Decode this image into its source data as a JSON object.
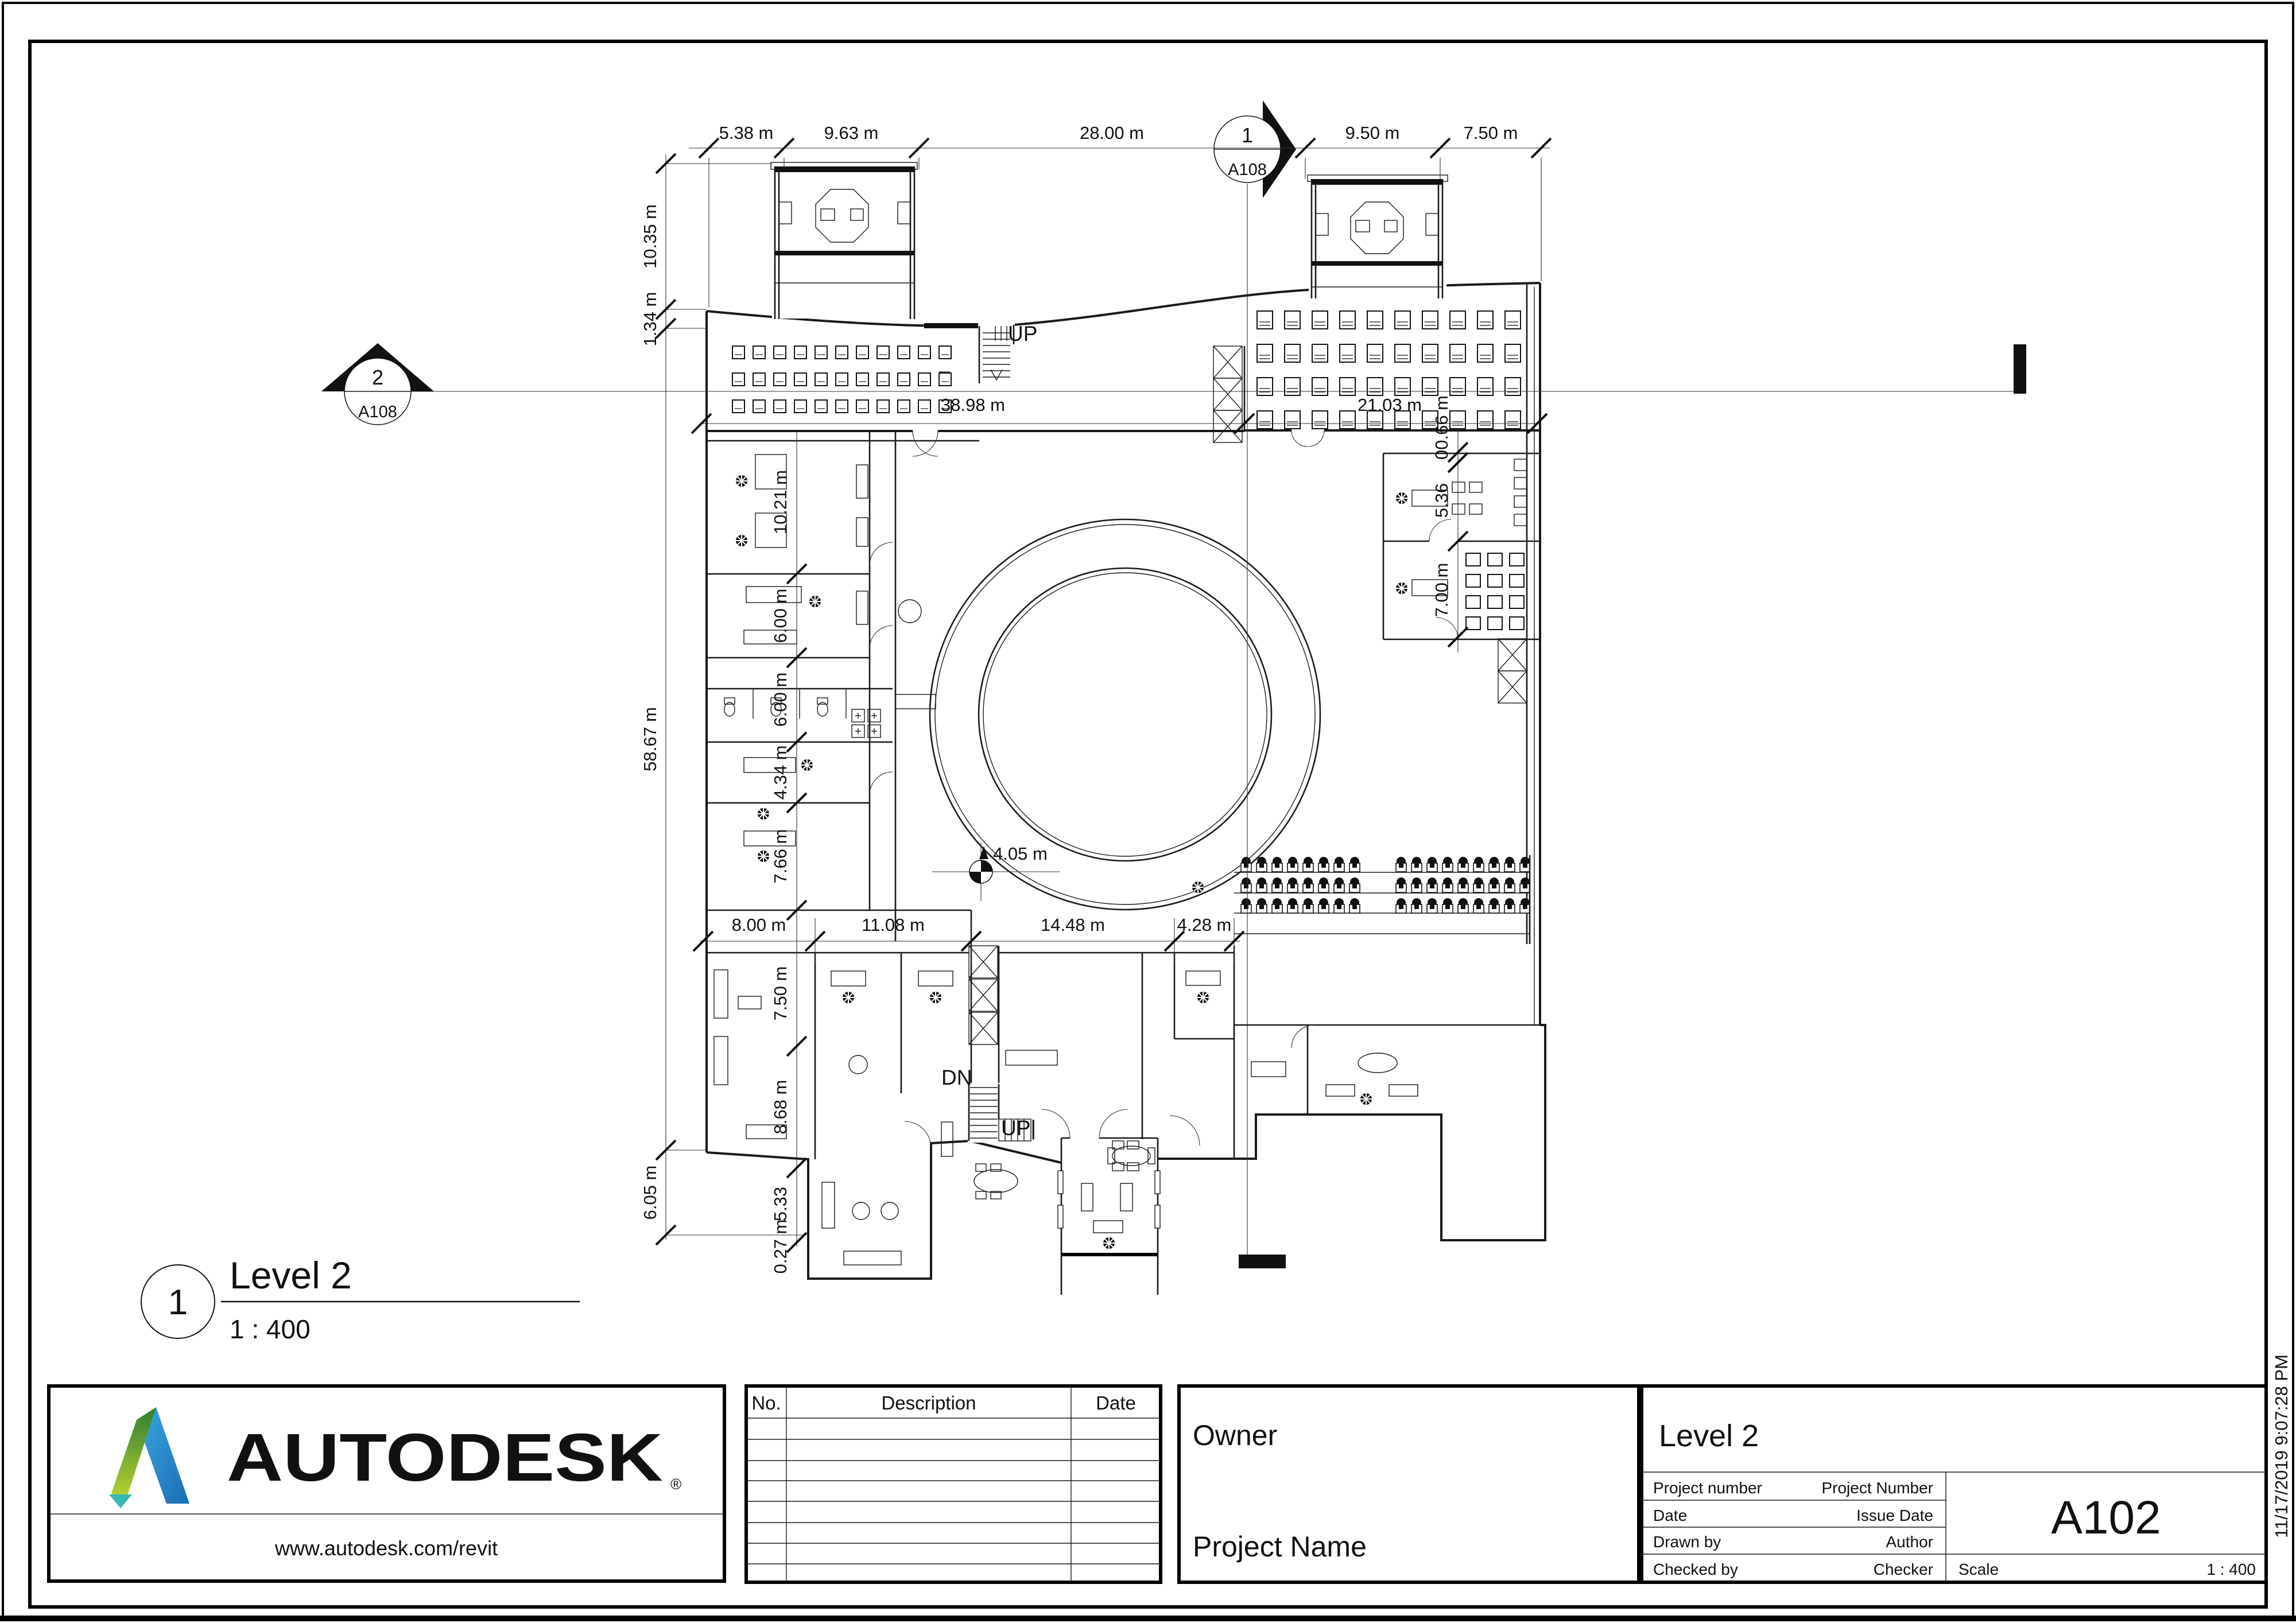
{
  "drawing": {
    "view": {
      "number": "1",
      "name": "Level 2",
      "scale": "1 : 400"
    },
    "stair_labels": {
      "upper": "UP",
      "down": "DN",
      "lower": "UP|"
    },
    "spot_dim": "4.05 m",
    "section_markers": {
      "one": {
        "number": "1",
        "sheet": "A108"
      },
      "two": {
        "number": "2",
        "sheet": "A108"
      }
    },
    "dims": {
      "top": [
        "5.38 m",
        "9.63 m",
        "28.00 m",
        "9.50 m",
        "7.50 m"
      ],
      "left_outer": [
        "10.35 m",
        "1.34 m",
        "58.67 m",
        "6.05 m"
      ],
      "interior_h": [
        "38.98 m",
        "21.03 m"
      ],
      "left_inner": [
        "10.21 m",
        "6.00 m",
        "6.00 m",
        "4.34 m",
        "7.66 m"
      ],
      "left_lower": [
        "7.50 m",
        "8.68 m",
        "5.33",
        "0.27 m"
      ],
      "middle": [
        "8.00 m",
        "11.08 m",
        "14.48 m",
        "4.28 m"
      ],
      "right_inner": [
        "00.66 m",
        "5.36",
        "7.00 m"
      ]
    }
  },
  "titleblock": {
    "brand": "AUTODESK",
    "registered": "®",
    "website": "www.autodesk.com/revit",
    "revision_table": {
      "no": "No.",
      "description": "Description",
      "date": "Date"
    },
    "owner": "Owner",
    "project_name": "Project Name",
    "view_name": "Level 2",
    "fields": [
      {
        "label": "Project number",
        "value": "Project Number"
      },
      {
        "label": "Date",
        "value": "Issue Date"
      },
      {
        "label": "Drawn by",
        "value": "Author"
      },
      {
        "label": "Checked by",
        "value": "Checker"
      }
    ],
    "sheet_number": "A102",
    "scale_label": "Scale",
    "scale_value": "1 : 400"
  },
  "timestamp": "11/17/2019 9:07:28 PM"
}
